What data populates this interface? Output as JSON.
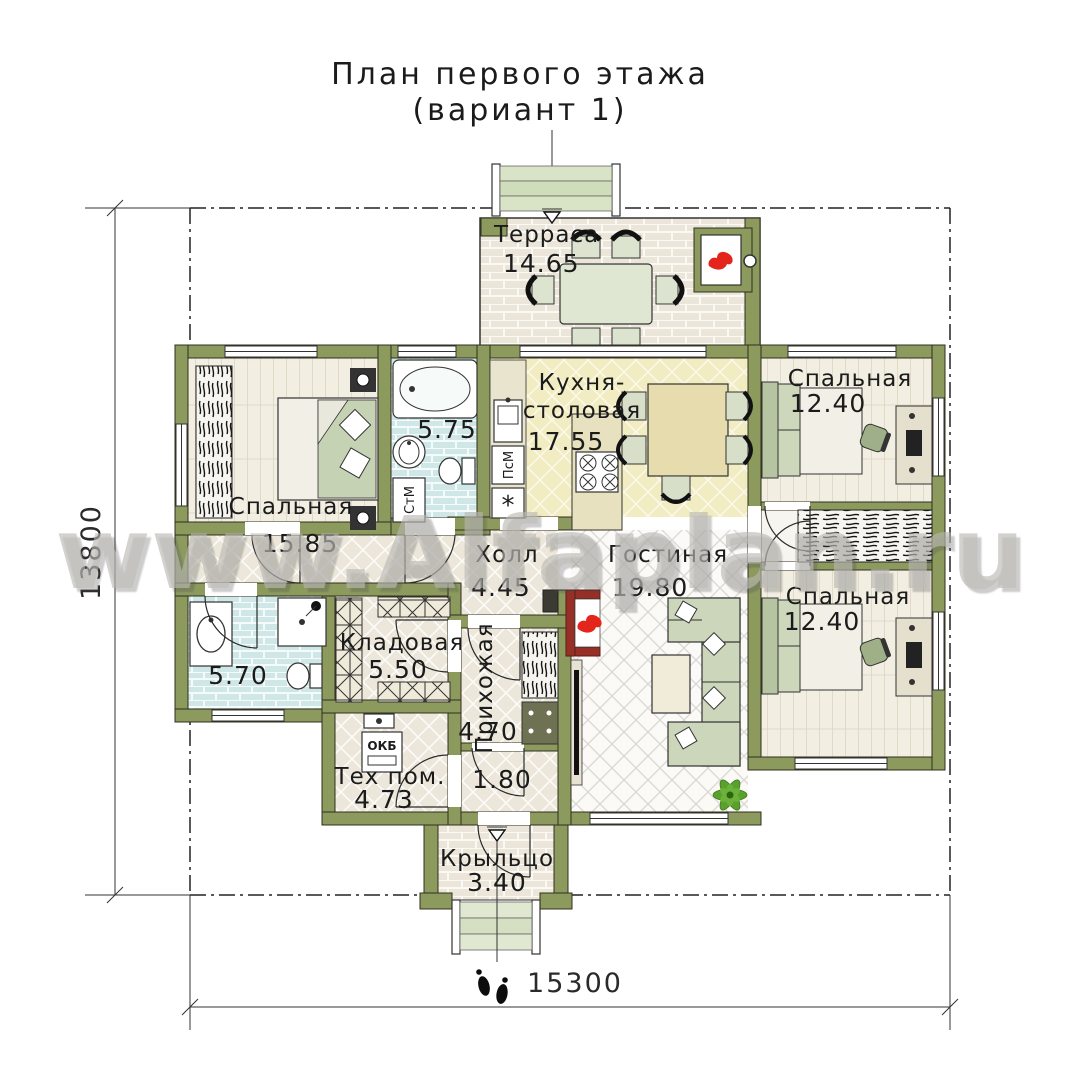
{
  "title": {
    "line1": "План первого этажа",
    "line2": "(вариант 1)"
  },
  "watermark": {
    "text": "www.Alfaplan.ru"
  },
  "dims": {
    "depth": "13800",
    "width": "15300"
  },
  "rooms": {
    "terrace": {
      "name": "Терраса",
      "area": "14.65"
    },
    "kitchen_dining": {
      "name_line1": "Кухня-",
      "name_line2": "столовая",
      "area": "17.55"
    },
    "bedroom_left": {
      "name": "Спальная",
      "area": "15.85"
    },
    "bathroom_top": {
      "area": "5.75"
    },
    "bedroom_top_right": {
      "name": "Спальная",
      "area": "12.40"
    },
    "hall": {
      "name": "Холл",
      "area": "4.45"
    },
    "living_room": {
      "name": "Гостиная",
      "area": "19.80"
    },
    "bedroom_bottom_right": {
      "name": "Спальная",
      "area": "12.40"
    },
    "bathroom_bottom": {
      "area": "5.70"
    },
    "storage": {
      "name": "Кладовая",
      "area": "5.50"
    },
    "entry_hall": {
      "name": "Прихожая",
      "area": "4.70"
    },
    "tech_room": {
      "name": "Тех пом.",
      "area": "4.73"
    },
    "vestibule": {
      "area": "1.80"
    },
    "porch": {
      "name": "Крыльцо",
      "area": "3.40"
    }
  },
  "labels": {
    "washing_machine": "СтМ",
    "dishwasher": "ПсМ",
    "boiler": "ОКБ",
    "fridge": "*"
  },
  "colors": {
    "wall": "#8c9a5e",
    "flame_red": "#e4251b",
    "fireplace_frame": "#962f26",
    "bathroom_floor": "#cfe7e6",
    "kitchen_floor": "#f2ecc2",
    "wood_floor": "#f2eee2",
    "terrace_floor": "#ebe6d9",
    "plant_green": "#59a12c"
  }
}
